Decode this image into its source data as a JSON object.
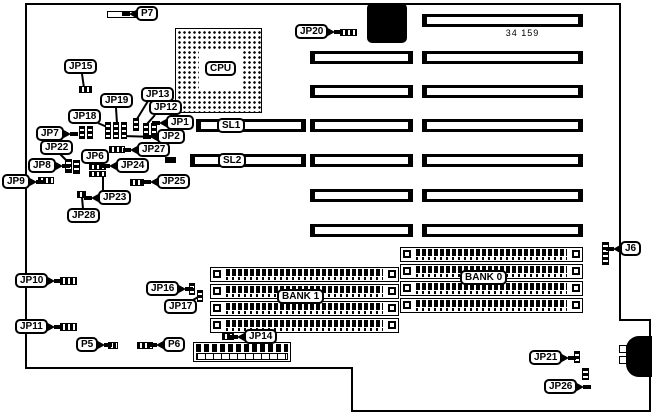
{
  "diagram": {
    "part_number": "34 159",
    "cpu": "CPU",
    "slots": {
      "sl1": "SL1",
      "sl2": "SL2"
    },
    "banks": {
      "bank0": "BANK 0",
      "bank1": "BANK 1"
    },
    "callouts": {
      "p7": "P7",
      "jp20": "JP20",
      "jp15": "JP15",
      "jp19": "JP19",
      "jp13": "JP13",
      "jp18": "JP18",
      "jp12": "JP12",
      "jp1": "JP1",
      "jp2": "JP2",
      "jp7": "JP7",
      "jp22": "JP22",
      "jp8": "JP8",
      "jp6": "JP6",
      "jp24": "JP24",
      "jp27": "JP27",
      "jp9": "JP9",
      "jp25": "JP25",
      "jp23": "JP23",
      "jp28": "JP28",
      "jp10": "JP10",
      "jp11": "JP11",
      "jp16": "JP16",
      "jp17": "JP17",
      "p5": "P5",
      "p6": "P6",
      "jp14": "JP14",
      "j6": "J6",
      "jp21": "JP21",
      "jp26": "JP26"
    }
  }
}
